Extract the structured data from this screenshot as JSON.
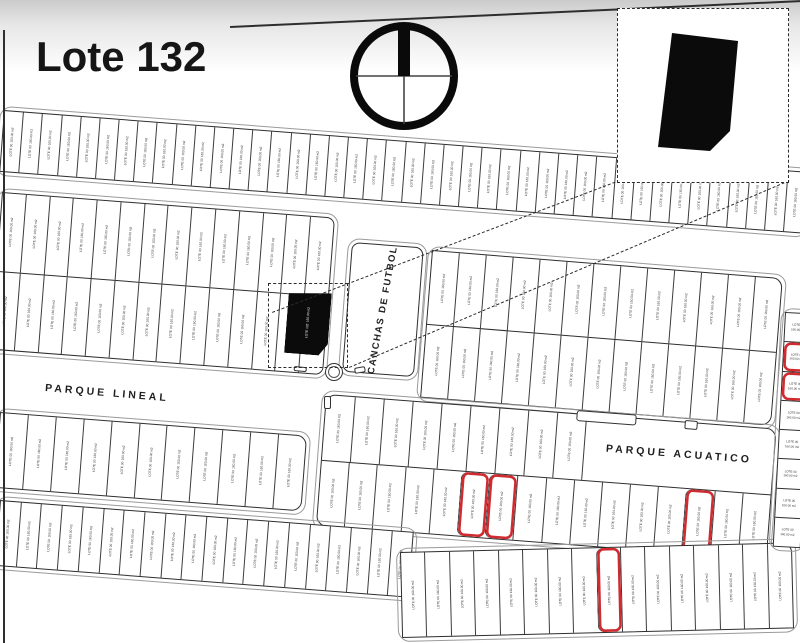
{
  "title": "Lote 132",
  "colors": {
    "ink": "#2e2e2e",
    "red": "#d02b30",
    "paper": "#ffffff",
    "black_fill": "#0b0b0b",
    "top_shade": "#cbcbcb"
  },
  "labels": {
    "parque_lineal": "PARQUE LINEAL",
    "parque_acuatico": "PARQUE ACUATICO",
    "canchas_futbol": "CANCHAS DE FUTBOL",
    "lot_line1": "LOTE 00",
    "lot_line2": "160.00 m2",
    "featured_lot_line1": "LOTE 132",
    "featured_lot_line2": "160.00 m2"
  },
  "icons": {
    "compass": "north-compass-icon"
  },
  "map": {
    "blocks": [
      {
        "name": "band-a",
        "x": 4,
        "y": 110,
        "w": 806,
        "h": 62,
        "rot": 4.4,
        "rows": 1,
        "lots": 42
      },
      {
        "name": "band-b-left",
        "x": 2,
        "y": 192,
        "w": 334,
        "h": 158,
        "rot": 4.4,
        "rows": 2,
        "lots": 14,
        "radius": "0 8px 8px 0"
      },
      {
        "name": "band-b-right",
        "x": 432,
        "y": 250,
        "w": 352,
        "h": 148,
        "rot": 4.6,
        "rows": 2,
        "lots": 13,
        "radius": "0 10px 10px 0"
      },
      {
        "name": "band-c-left",
        "x": 0,
        "y": 412,
        "w": 308,
        "h": 76,
        "rot": 4.4,
        "rows": 1,
        "lots": 11,
        "radius": "0 10px 10px 0"
      },
      {
        "name": "band-c-right",
        "x": 326,
        "y": 394,
        "w": 452,
        "h": 132,
        "rot": 4.4,
        "rows": 2,
        "lots": 16,
        "radius": "10px",
        "red": {
          "1": [
            5,
            6,
            13
          ]
        },
        "wide": {
          "row": 0,
          "lots": 9,
          "frac": 0.42,
          "label_key": "parque_acuatico"
        }
      },
      {
        "name": "band-d-left",
        "x": 0,
        "y": 500,
        "w": 415,
        "h": 66,
        "rot": 4.4,
        "rows": 1,
        "lots": 20
      },
      {
        "name": "band-d-right",
        "x": 400,
        "y": 552,
        "w": 392,
        "h": 86,
        "rot": -1.4,
        "rows": 1,
        "lots": 16,
        "red": {
          "0": [
            8
          ]
        },
        "radius": "0 10px 0 0"
      },
      {
        "name": "strip-right",
        "x": 785,
        "y": 312,
        "w": 28,
        "h": 235,
        "rot": 3,
        "rows": 8,
        "lots": 1,
        "red_rows": [
          1,
          2
        ],
        "text": "h"
      }
    ]
  }
}
